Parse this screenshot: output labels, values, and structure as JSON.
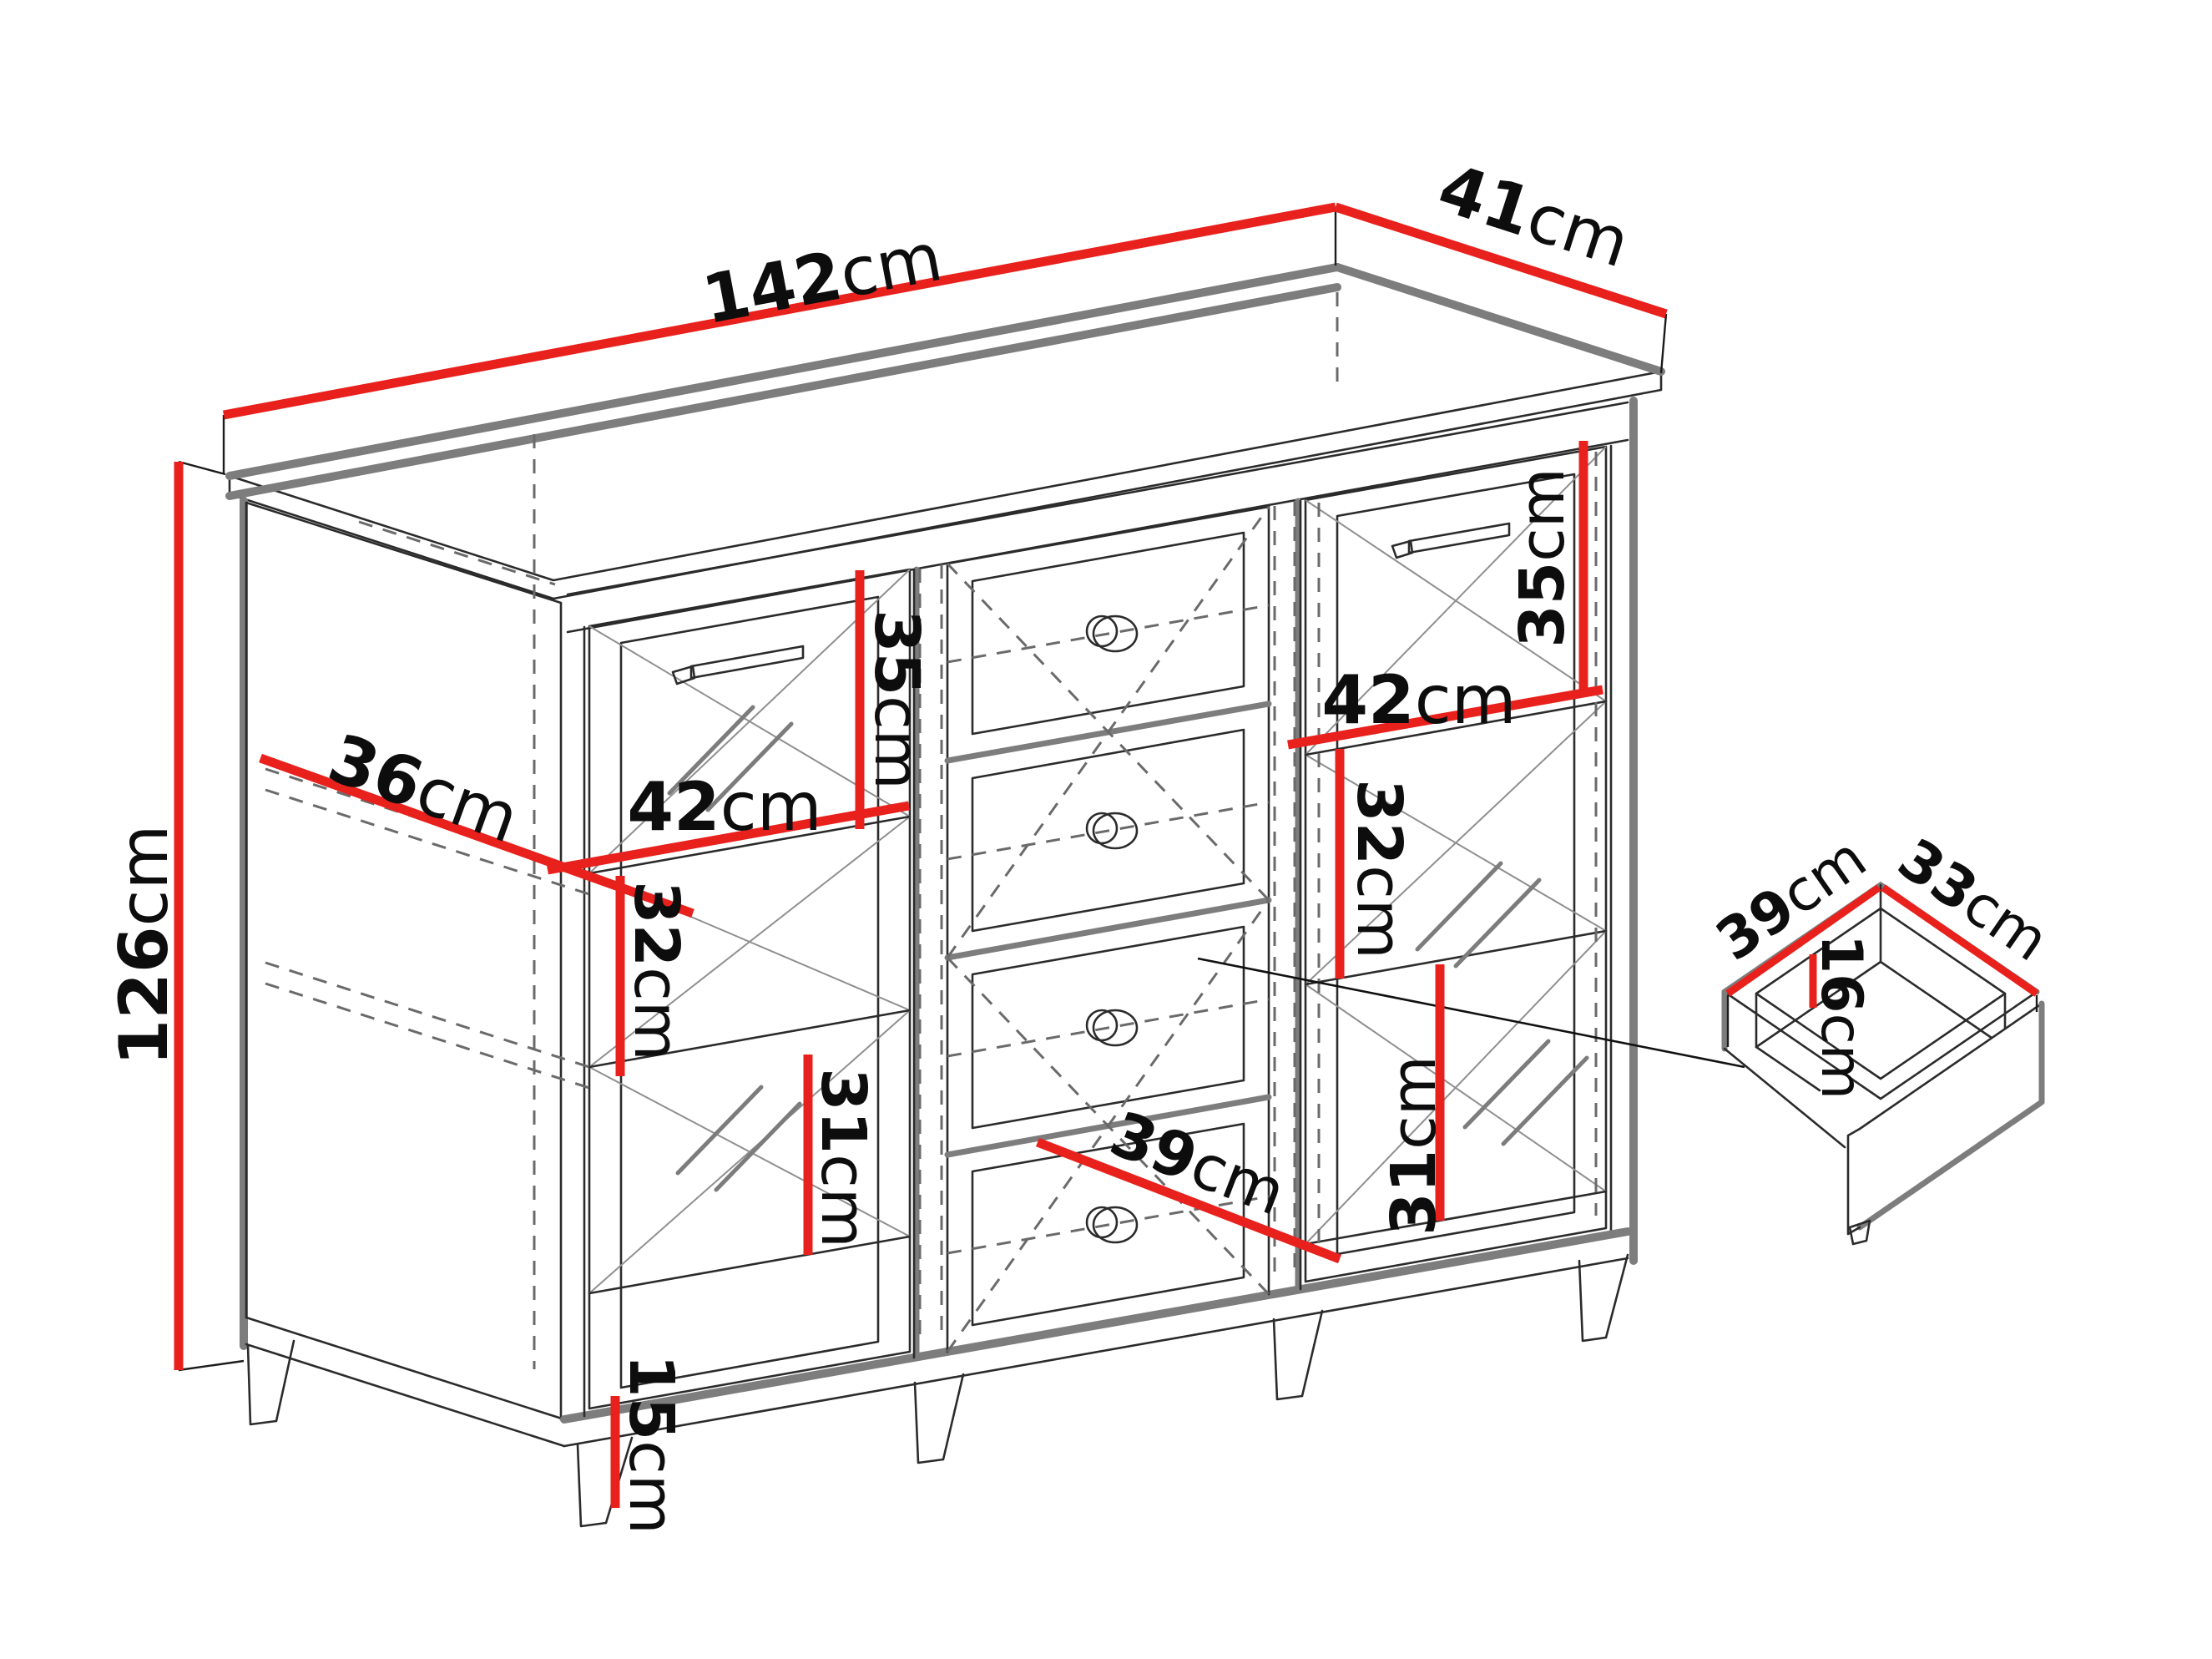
{
  "diagram": {
    "subject": "Sideboard dimensions diagram",
    "unit": "cm",
    "accent_color": "#e8211d",
    "outline_color": "#2b2b2b",
    "shadow_color": "#7d7d7d",
    "background_color": "#ffffff"
  },
  "cabinet": {
    "width": {
      "value": "142",
      "unit": "cm"
    },
    "depth": {
      "value": "41",
      "unit": "cm"
    },
    "height": {
      "value": "126",
      "unit": "cm"
    },
    "interior_depth": {
      "value": "36",
      "unit": "cm"
    },
    "leg_height": {
      "value": "15",
      "unit": "cm"
    },
    "bottom_drawer_width": {
      "value": "39",
      "unit": "cm"
    },
    "left_section": {
      "top_height": {
        "value": "35",
        "unit": "cm"
      },
      "door_width": {
        "value": "42",
        "unit": "cm"
      },
      "middle_height": {
        "value": "32",
        "unit": "cm"
      },
      "bottom_height": {
        "value": "31",
        "unit": "cm"
      }
    },
    "right_section": {
      "top_height": {
        "value": "35",
        "unit": "cm"
      },
      "door_width": {
        "value": "42",
        "unit": "cm"
      },
      "middle_height": {
        "value": "32",
        "unit": "cm"
      },
      "bottom_height": {
        "value": "31",
        "unit": "cm"
      }
    }
  },
  "drawer_detail": {
    "depth": {
      "value": "39",
      "unit": "cm"
    },
    "width": {
      "value": "33",
      "unit": "cm"
    },
    "inner_height": {
      "value": "16",
      "unit": "cm"
    }
  }
}
